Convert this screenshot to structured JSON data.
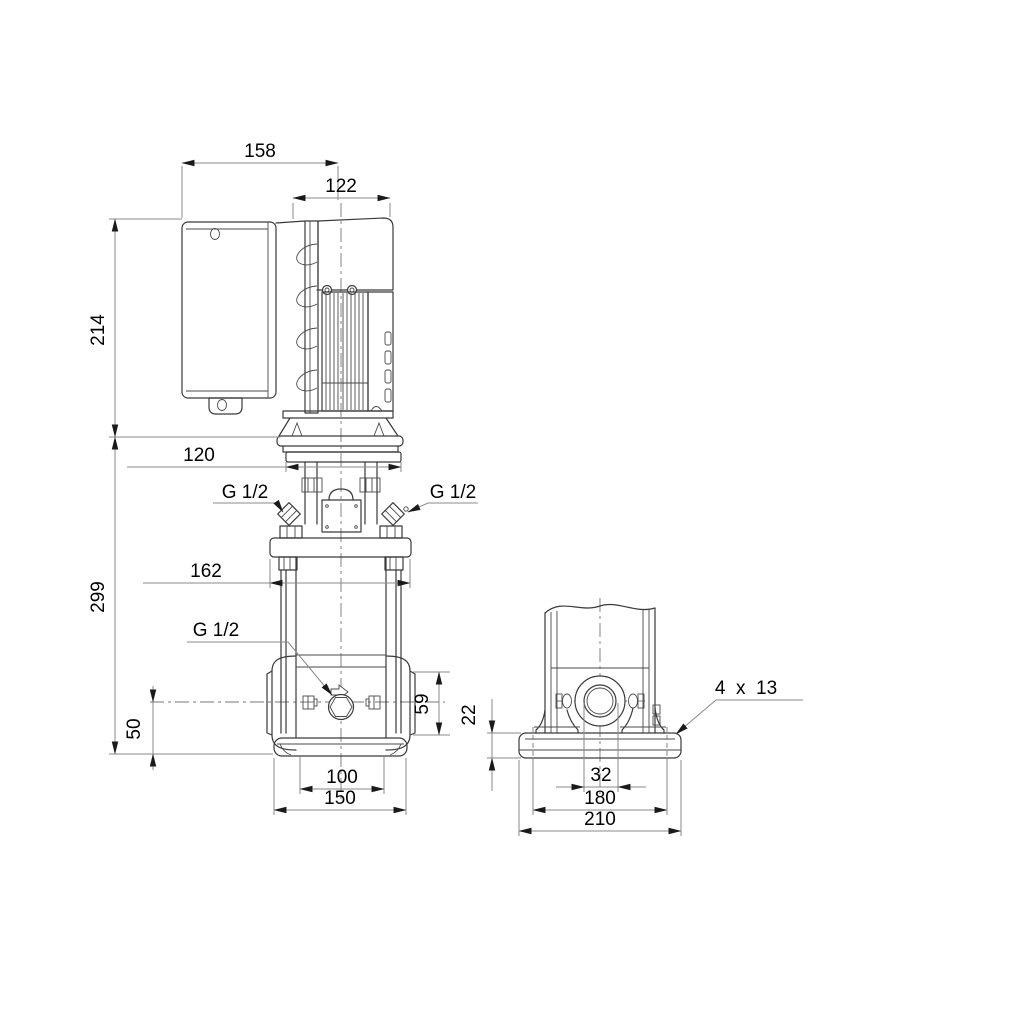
{
  "drawing": {
    "kind": "pump-dimensional-drawing",
    "background": "#ffffff",
    "line_color": "#3a3a3a",
    "dimension_line_color": "#8a8a8a",
    "text_color": "#000000"
  },
  "dims": {
    "d158": "158",
    "d122": "122",
    "d214": "214",
    "d299": "299",
    "d120": "120",
    "d162": "162",
    "d50": "50",
    "d59": "59",
    "d100": "100",
    "d150": "150",
    "d22": "22",
    "d32": "32",
    "d180": "180",
    "d210": "210",
    "g_half_top_left": "G 1/2",
    "g_half_top_right": "G 1/2",
    "g_half_drain": "G 1/2",
    "bolt_holes": "4  x  13"
  }
}
